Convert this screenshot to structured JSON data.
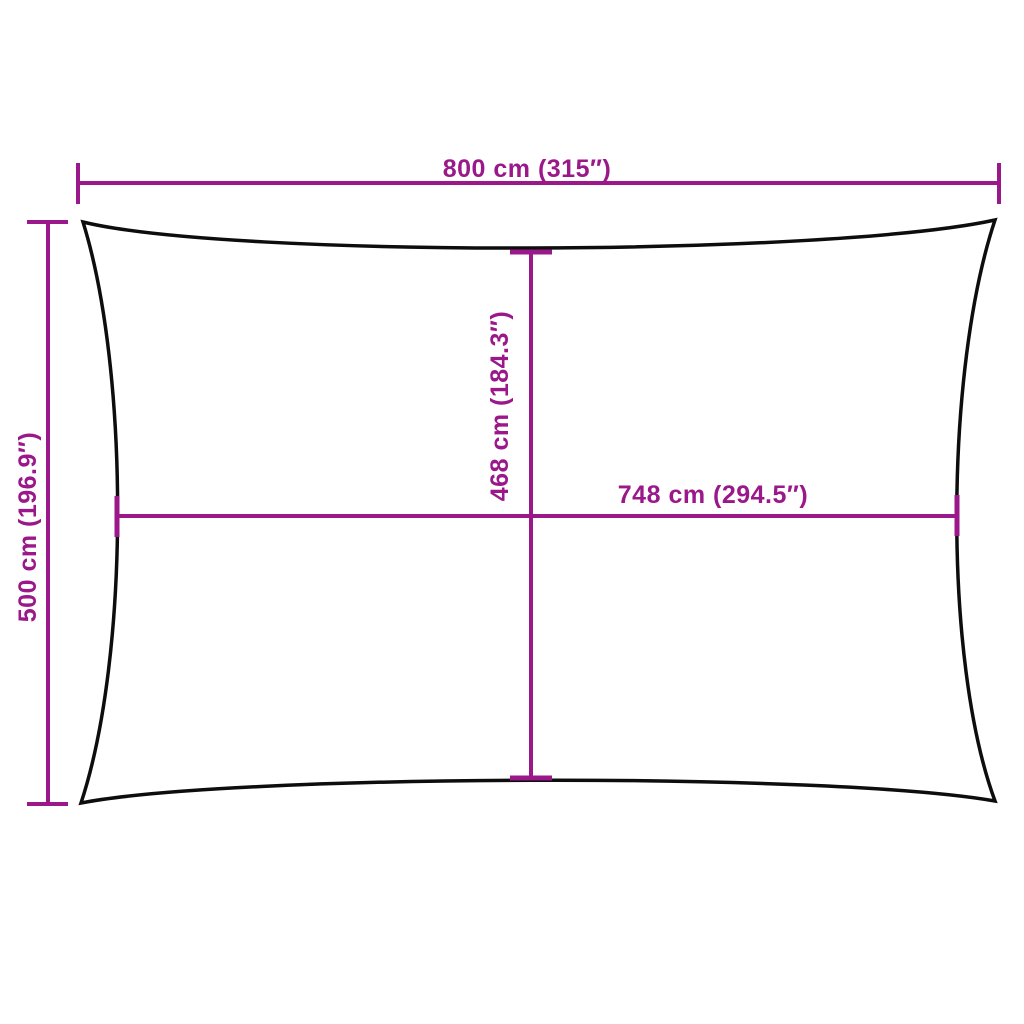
{
  "colors": {
    "dimension": "#9A1889",
    "outline": "#0d0d0d",
    "background": "#ffffff"
  },
  "diagram": {
    "dimensions": {
      "outer_width": {
        "label": "800 cm (315″)",
        "cm": 800,
        "inches": 315
      },
      "outer_height": {
        "label": "500 cm (196.9″)",
        "cm": 500,
        "inches": 196.9
      },
      "inner_height": {
        "label": "468 cm (184.3″)",
        "cm": 468,
        "inches": 184.3
      },
      "inner_width": {
        "label": "748 cm (294.5″)",
        "cm": 748,
        "inches": 294.5
      }
    }
  }
}
